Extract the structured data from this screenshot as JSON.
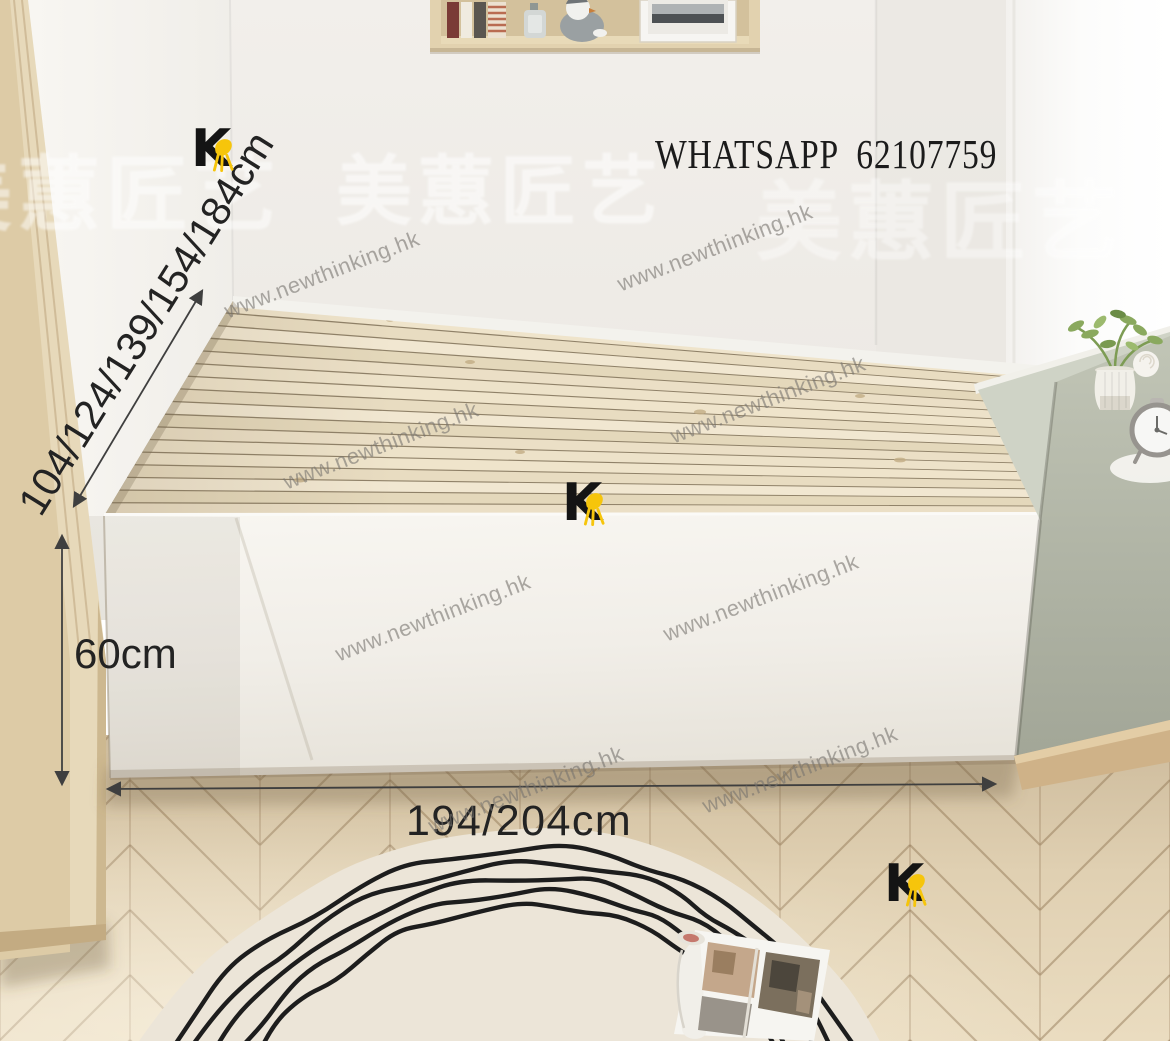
{
  "annotations": {
    "whatsapp_text": "WHATSAPP  62107759",
    "depth_label": "104/124/139/154/184cm",
    "height_label": "60cm",
    "width_label": "194/204cm"
  },
  "watermarks": {
    "text": "www.newthinking.hk",
    "color": "#76736e",
    "angle_deg": -21,
    "positions": [
      {
        "x": 322,
        "y": 275
      },
      {
        "x": 715,
        "y": 248
      },
      {
        "x": 381,
        "y": 446
      },
      {
        "x": 768,
        "y": 400
      },
      {
        "x": 433,
        "y": 618
      },
      {
        "x": 761,
        "y": 598
      },
      {
        "x": 526,
        "y": 790
      },
      {
        "x": 800,
        "y": 770
      }
    ]
  },
  "ghost_watermark": {
    "text": "美蕙匠艺",
    "positions": [
      {
        "x": -70,
        "y": 128,
        "size": 82,
        "opacity": 0.5
      },
      {
        "x": 336,
        "y": 130,
        "size": 76,
        "opacity": 0.55
      },
      {
        "x": 756,
        "y": 152,
        "size": 86,
        "opacity": 0.4
      }
    ]
  },
  "brand_logo": {
    "letter": "K",
    "letter_color": "#141414",
    "chair_color": "#F6C50B",
    "positions": [
      {
        "x": 191,
        "y": 127
      },
      {
        "x": 562,
        "y": 481
      },
      {
        "x": 884,
        "y": 862
      }
    ]
  },
  "palette": {
    "wall": "#efece7",
    "left_wall": "#f6f4f0",
    "window_light": "#fbfbfa",
    "wardrobe_wood": "#e7d9ba",
    "shelf_wood": "#ddcca9",
    "slat_wood": "#eadfc6",
    "slat_gap": "#8f8168",
    "bed_frame": "#f4f2ec",
    "sill_cabinet": "#b5b9aa",
    "floor_wood": "#dfcfb2",
    "rug": "#ece5d8",
    "rug_lines": "#1d1d1d",
    "dimension": "#3f3f3f"
  }
}
